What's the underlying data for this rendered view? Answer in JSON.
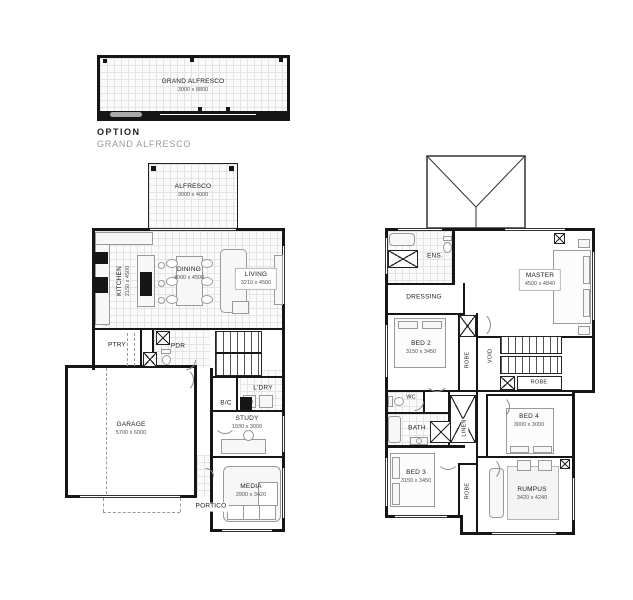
{
  "option": {
    "label": "OPTION",
    "subtitle": "GRAND ALFRESCO",
    "room": {
      "name": "GRAND ALFRESCO",
      "dims": "3000 x 8800"
    }
  },
  "ground": {
    "alfresco": {
      "name": "ALFRESCO",
      "dims": "3000 x 4000"
    },
    "kitchen": {
      "name": "KITCHEN",
      "dims": "2150 x 4500"
    },
    "dining": {
      "name": "DINING",
      "dims": "4000 x 4500"
    },
    "living": {
      "name": "LIVING",
      "dims": "3210 x 4500"
    },
    "pantry": {
      "name": "PTRY"
    },
    "powder": {
      "name": "PDR"
    },
    "garage": {
      "name": "GARAGE",
      "dims": "5700 x 6000"
    },
    "laundry": {
      "name": "L'DRY"
    },
    "bc": {
      "name": "B/C"
    },
    "study": {
      "name": "STUDY",
      "dims": "1930 x 3000"
    },
    "media": {
      "name": "MEDIA",
      "dims": "2900 x 3420"
    },
    "portico": {
      "name": "PORTICO"
    }
  },
  "first": {
    "ens": {
      "name": "ENS."
    },
    "dressing": {
      "name": "DRESSING"
    },
    "master": {
      "name": "MASTER",
      "dims": "4500 x 4840"
    },
    "bed2": {
      "name": "BED 2",
      "dims": "3150 x 3450"
    },
    "robe2": {
      "name": "ROBE"
    },
    "void": {
      "name": "VOID"
    },
    "robe_stairs": {
      "name": "ROBE"
    },
    "wc": {
      "name": "WC"
    },
    "bath": {
      "name": "BATH"
    },
    "linen": {
      "name": "LINEN"
    },
    "bed4": {
      "name": "BED 4",
      "dims": "3000 x 3000"
    },
    "bed3": {
      "name": "BED 3",
      "dims": "3150 x 3450"
    },
    "robe3": {
      "name": "ROBE"
    },
    "rumpus": {
      "name": "RUMPUS",
      "dims": "3420 x 4240"
    }
  },
  "colors": {
    "wall": "#161616",
    "grid": "#e4e4e4",
    "furniture": "#9a9a9a",
    "subtitle": "#9b9b9b"
  }
}
